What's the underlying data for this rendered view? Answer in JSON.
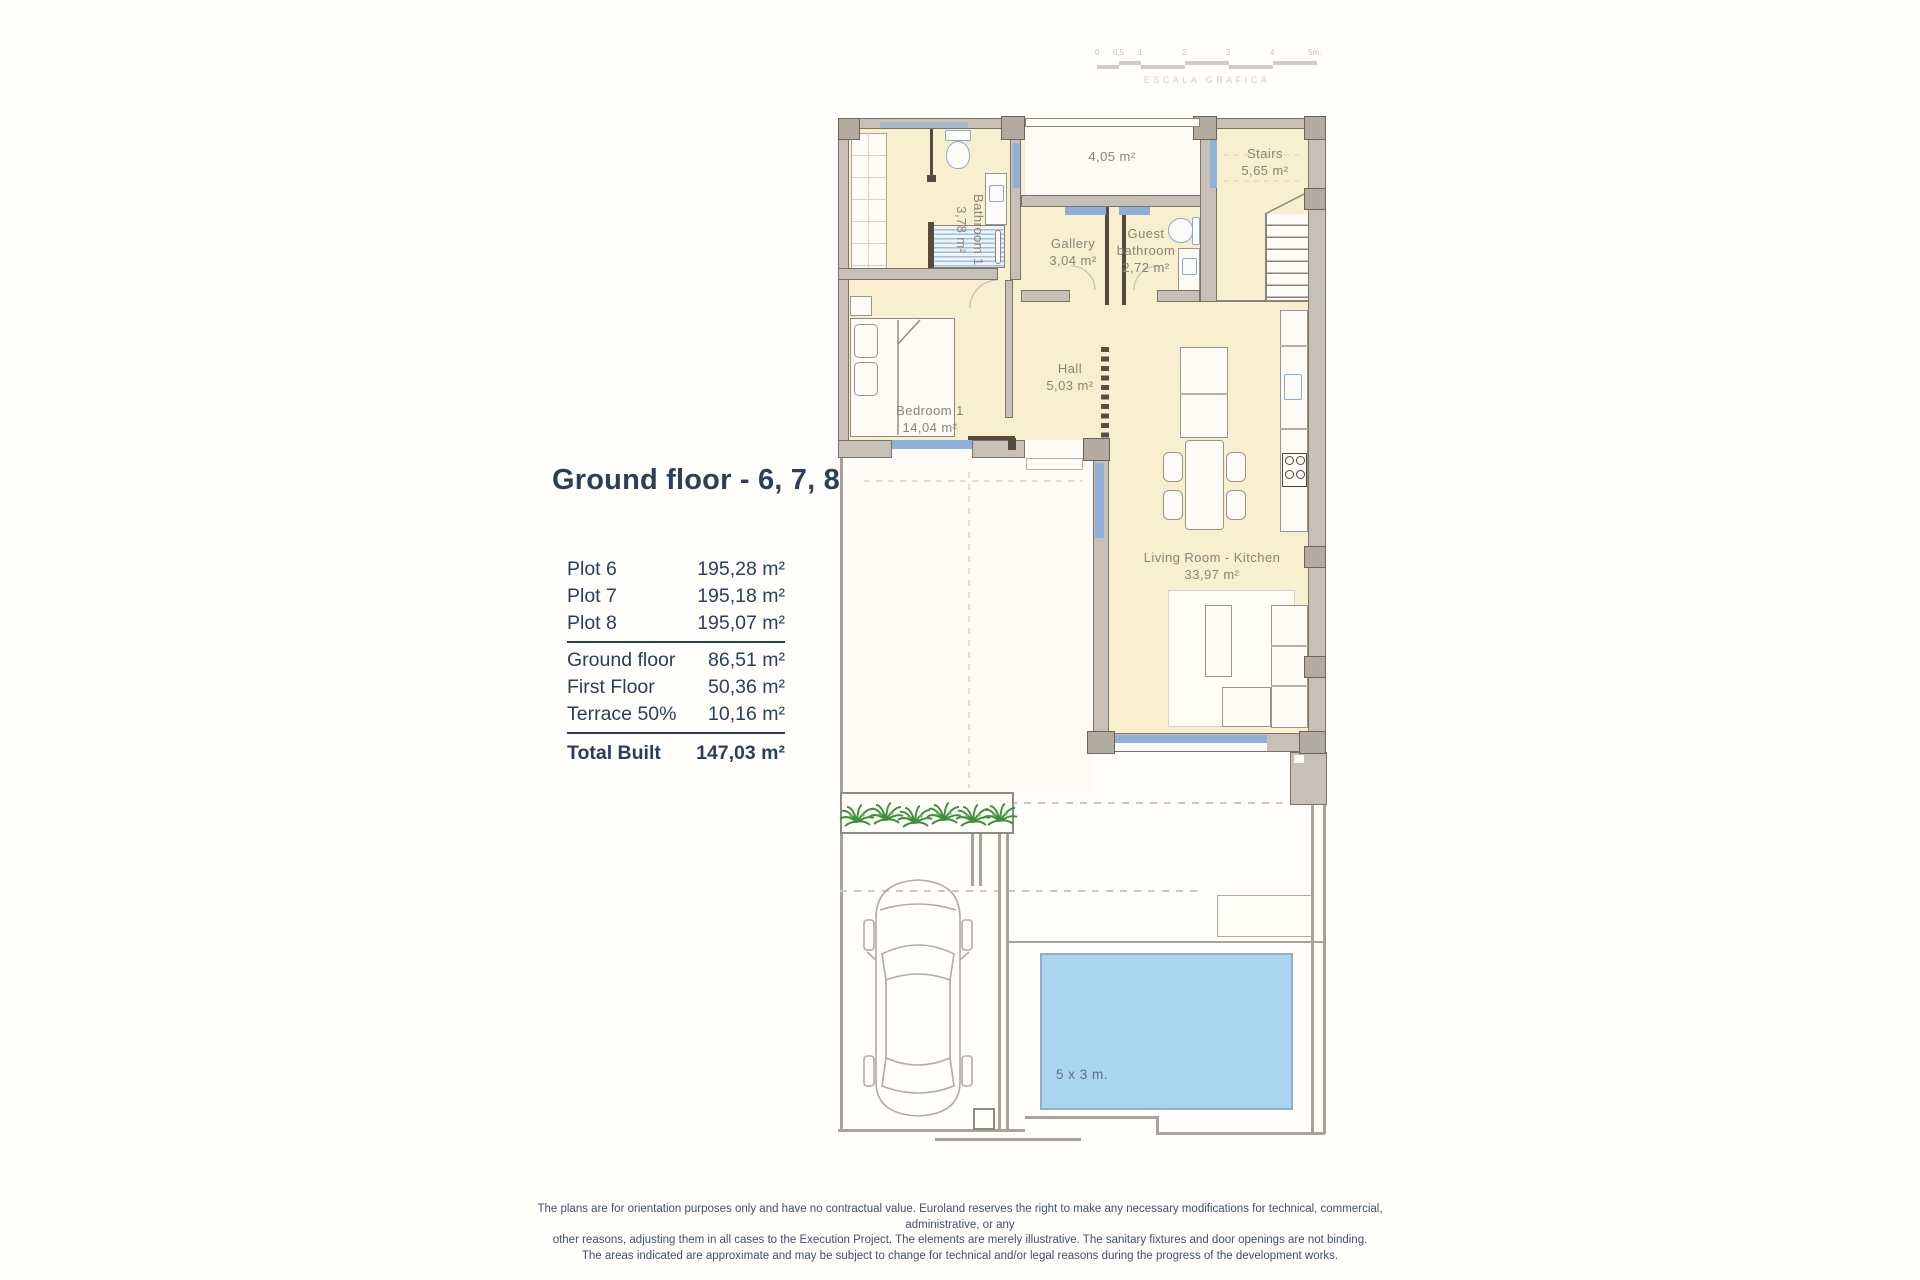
{
  "title": "Ground floor - 6, 7, 8",
  "summary": {
    "plots": [
      {
        "label": "Plot 6",
        "value": "195,28 m²"
      },
      {
        "label": "Plot 7",
        "value": "195,18 m²"
      },
      {
        "label": "Plot 8",
        "value": "195,07 m²"
      }
    ],
    "areas": [
      {
        "label": "Ground floor",
        "value": "86,51 m²"
      },
      {
        "label": "First Floor",
        "value": "50,36 m²"
      },
      {
        "label": "Terrace 50%",
        "value": "10,16 m²"
      }
    ],
    "total": {
      "label": "Total Built",
      "value": "147,03 m²"
    }
  },
  "scalebar": {
    "labels": [
      "0",
      "0,5",
      "1",
      "2",
      "3",
      "4",
      "5m."
    ],
    "caption": "ESCALA GRAFICA"
  },
  "rooms": {
    "bathroom1": {
      "name": "Bathroom 1",
      "area": "3,78 m²"
    },
    "terrace": {
      "area": "4,05 m²"
    },
    "stairs": {
      "name": "Stairs",
      "area": "5,65 m²"
    },
    "gallery": {
      "name": "Gallery",
      "area": "3,04 m²"
    },
    "guest_bathroom": {
      "name": "Guest bathroom",
      "area": "2,72 m²"
    },
    "bedroom1": {
      "name": "Bedroom 1",
      "area": "14,04 m²"
    },
    "hall": {
      "name": "Hall",
      "area": "5,03 m²"
    },
    "living": {
      "name": "Living Room - Kitchen",
      "area": "33,97 m²"
    },
    "pool": {
      "label": "5 x 3 m."
    }
  },
  "disclaimer": {
    "line1": "The plans are for orientation purposes only and have no contractual value. Euroland reserves the right to make any necessary modifications for technical, commercial, administrative, or any",
    "line2": "other reasons, adjusting them in all cases to the Execution Project. The elements are merely illustrative. The sanitary fixtures and door openings are not binding.",
    "line3": "The areas indicated are approximate and may be subject to change for technical and/or legal reasons during the progress of the development works."
  },
  "colors": {
    "accent_navy": "#2b3f5b",
    "floor_cream": "#f8efce",
    "wall_gray": "#c7c0b6",
    "wall_outline": "#7c7368",
    "window_blue": "#8fb0d9",
    "fixture_blue": "#85abce",
    "pool_blue": "#aad5ee",
    "plant_green": "#3f8f3c",
    "plan_label_gray": "#8c8272",
    "disclaimer_gray": "#42506a"
  }
}
